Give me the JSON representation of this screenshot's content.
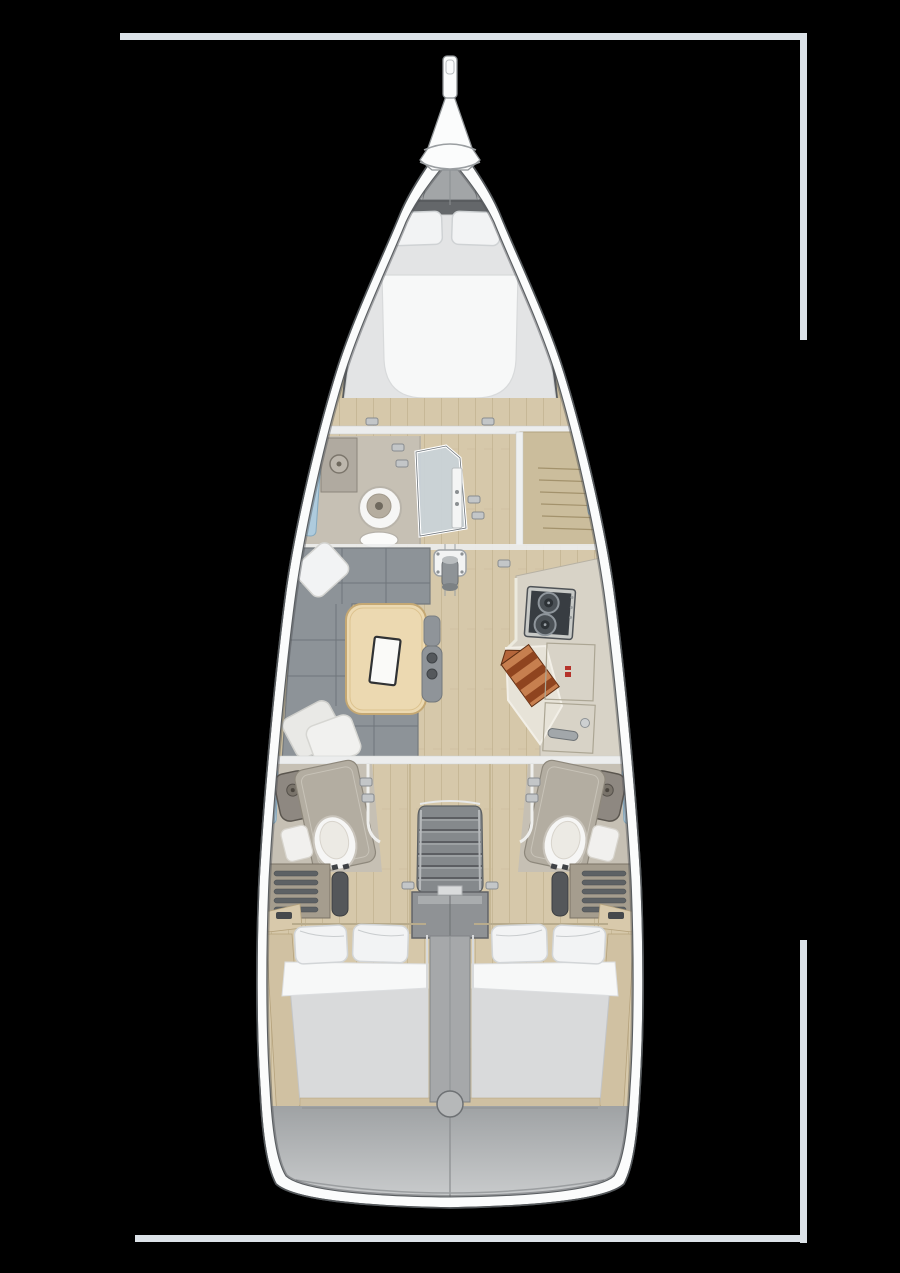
{
  "page": {
    "background": "#000000",
    "width": 900,
    "height": 1273
  },
  "diagram": {
    "type": "yacht-interior-floor-plan",
    "view": "top-down",
    "regions": [
      "bowsprit",
      "anchor-locker",
      "forward-v-berth",
      "forward-head",
      "shower-cabin",
      "starboard-wardrobe",
      "saloon-u-sofa",
      "saloon-table",
      "navigator-chair",
      "mast-step",
      "galley",
      "stove",
      "sink",
      "cutting-board",
      "port-aft-head",
      "starboard-aft-head",
      "companionway-stairs",
      "engine-compartment",
      "port-aft-berth",
      "starboard-aft-berth",
      "transom"
    ]
  },
  "palette": {
    "frame": "#dce2e8",
    "hull_band": "#fbfcfc",
    "hull_outline": "#54585b",
    "interior_base": "#8f9294",
    "deck": "#cbcdce",
    "anchor_locker": "#a2a5a7",
    "wood_floor": "#d6c8aa",
    "plank_line": "#c1b18f",
    "shelf_wood": "#cbbd9c",
    "berth_white": "#f7f8f8",
    "sheet_gray": "#e3e4e5",
    "headboard": "#64676a",
    "pillow": "#f2f3f4",
    "sofa": "#8d9398",
    "table_wood": "#ecd9b1",
    "table_edge": "#c5a873",
    "chair": "#8f9499",
    "glass": "#c9d3d9",
    "window_blue": "#aecbdd",
    "head_floor": "#c6c0b4",
    "counter": "#d8d3c7",
    "counter_light": "#e7e3d8",
    "stove_top": "#383d42",
    "stove_frame": "#c7c9c6",
    "burner": "#4b5156",
    "board_light": "#c77f4f",
    "board_dark": "#8f441f",
    "logo_red": "#b5322a",
    "toilet_white": "#f6f6f5",
    "basin_gray": "#8e8881",
    "vanity_tan": "#b3ada1",
    "louver_panel": "#a59d8e",
    "louver_slat": "#5d6164",
    "tread_dark": "#54575a",
    "stairs_gray": "#85898c",
    "stair_tread": "#56595c",
    "engine_gray": "#8f9295",
    "column_gray": "#a6a8aa",
    "mattress_gray": "#d9dadb",
    "quarter_wood": "#d0c1a2",
    "transom_top": "#9fa2a4",
    "transom_bottom": "#d3d5d6",
    "trim_white": "#eceded",
    "mast_plate": "#f2f3f3"
  }
}
